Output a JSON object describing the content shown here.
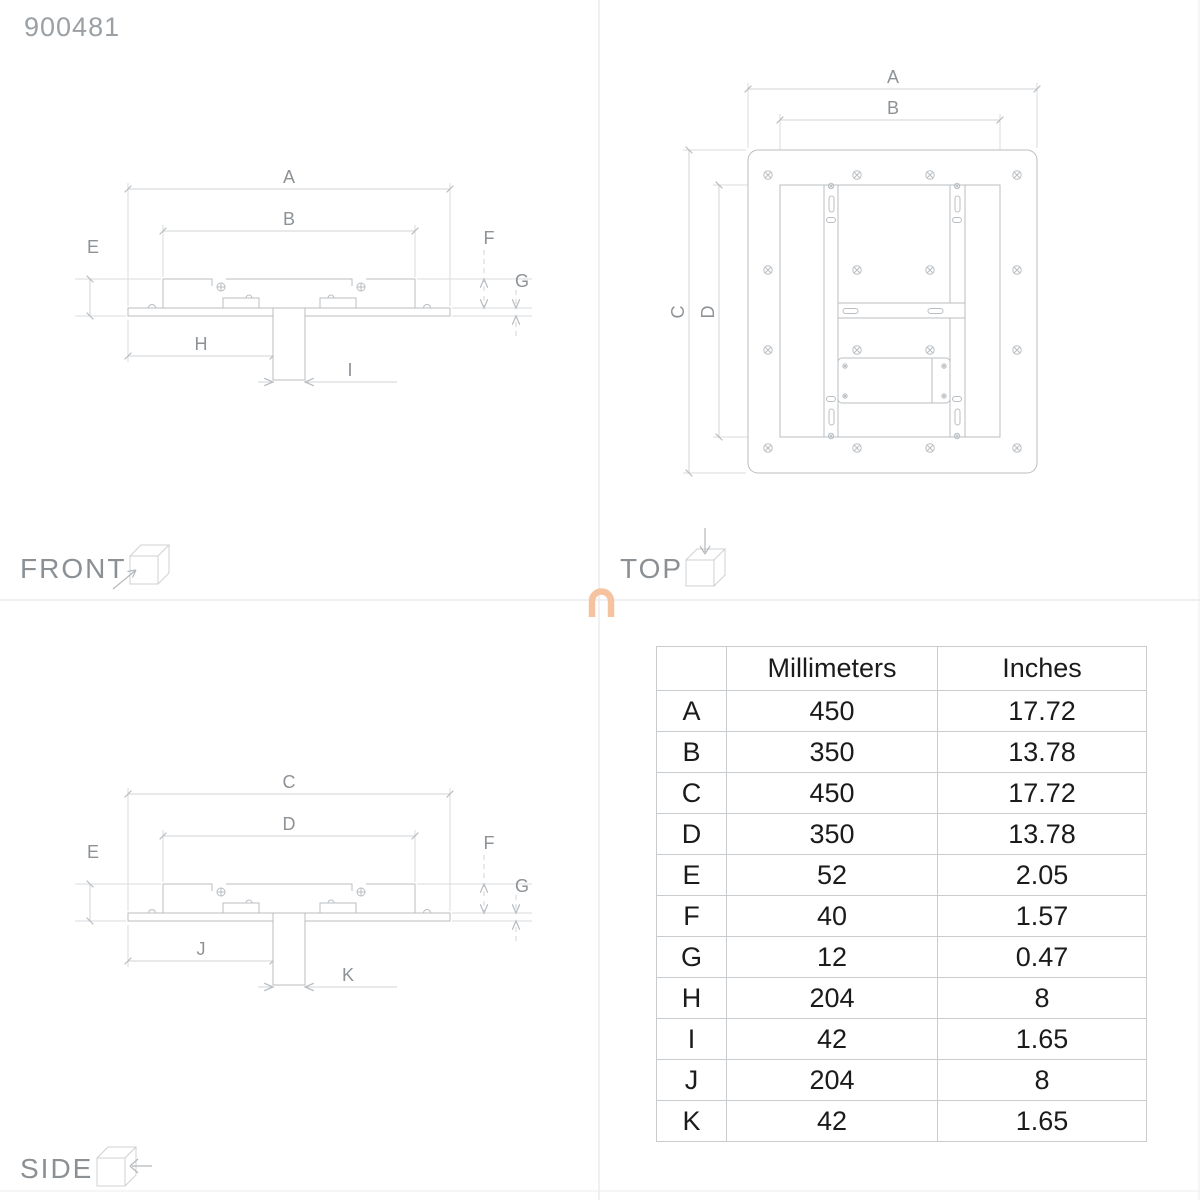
{
  "product_code": "900481",
  "views": {
    "front": {
      "title": "FRONT",
      "dim_labels": {
        "a": "A",
        "b": "B",
        "e": "E",
        "f": "F",
        "g": "G",
        "h": "H",
        "i": "I"
      }
    },
    "top": {
      "title": "TOP",
      "dim_labels": {
        "a": "A",
        "b": "B",
        "c": "C",
        "d": "D"
      }
    },
    "side": {
      "title": "SIDE",
      "dim_labels": {
        "c": "C",
        "d": "D",
        "e": "E",
        "f": "F",
        "g": "G",
        "j": "J",
        "k": "K"
      }
    }
  },
  "table": {
    "headers": [
      "Millimeters",
      "Inches"
    ],
    "rows": [
      [
        "A",
        "450",
        "17.72"
      ],
      [
        "B",
        "350",
        "13.78"
      ],
      [
        "C",
        "450",
        "17.72"
      ],
      [
        "D",
        "350",
        "13.78"
      ],
      [
        "E",
        "52",
        "2.05"
      ],
      [
        "F",
        "40",
        "1.57"
      ],
      [
        "G",
        "12",
        "0.47"
      ],
      [
        "H",
        "204",
        "8"
      ],
      [
        "I",
        "42",
        "1.65"
      ],
      [
        "J",
        "204",
        "8"
      ],
      [
        "K",
        "42",
        "1.65"
      ]
    ]
  },
  "colors": {
    "watermark": "#f6c3a0",
    "drawing_line": "#b9bec2",
    "dimension_line": "#cfd3d6",
    "label_text": "#8d9296",
    "table_text": "#1b1b1d"
  }
}
